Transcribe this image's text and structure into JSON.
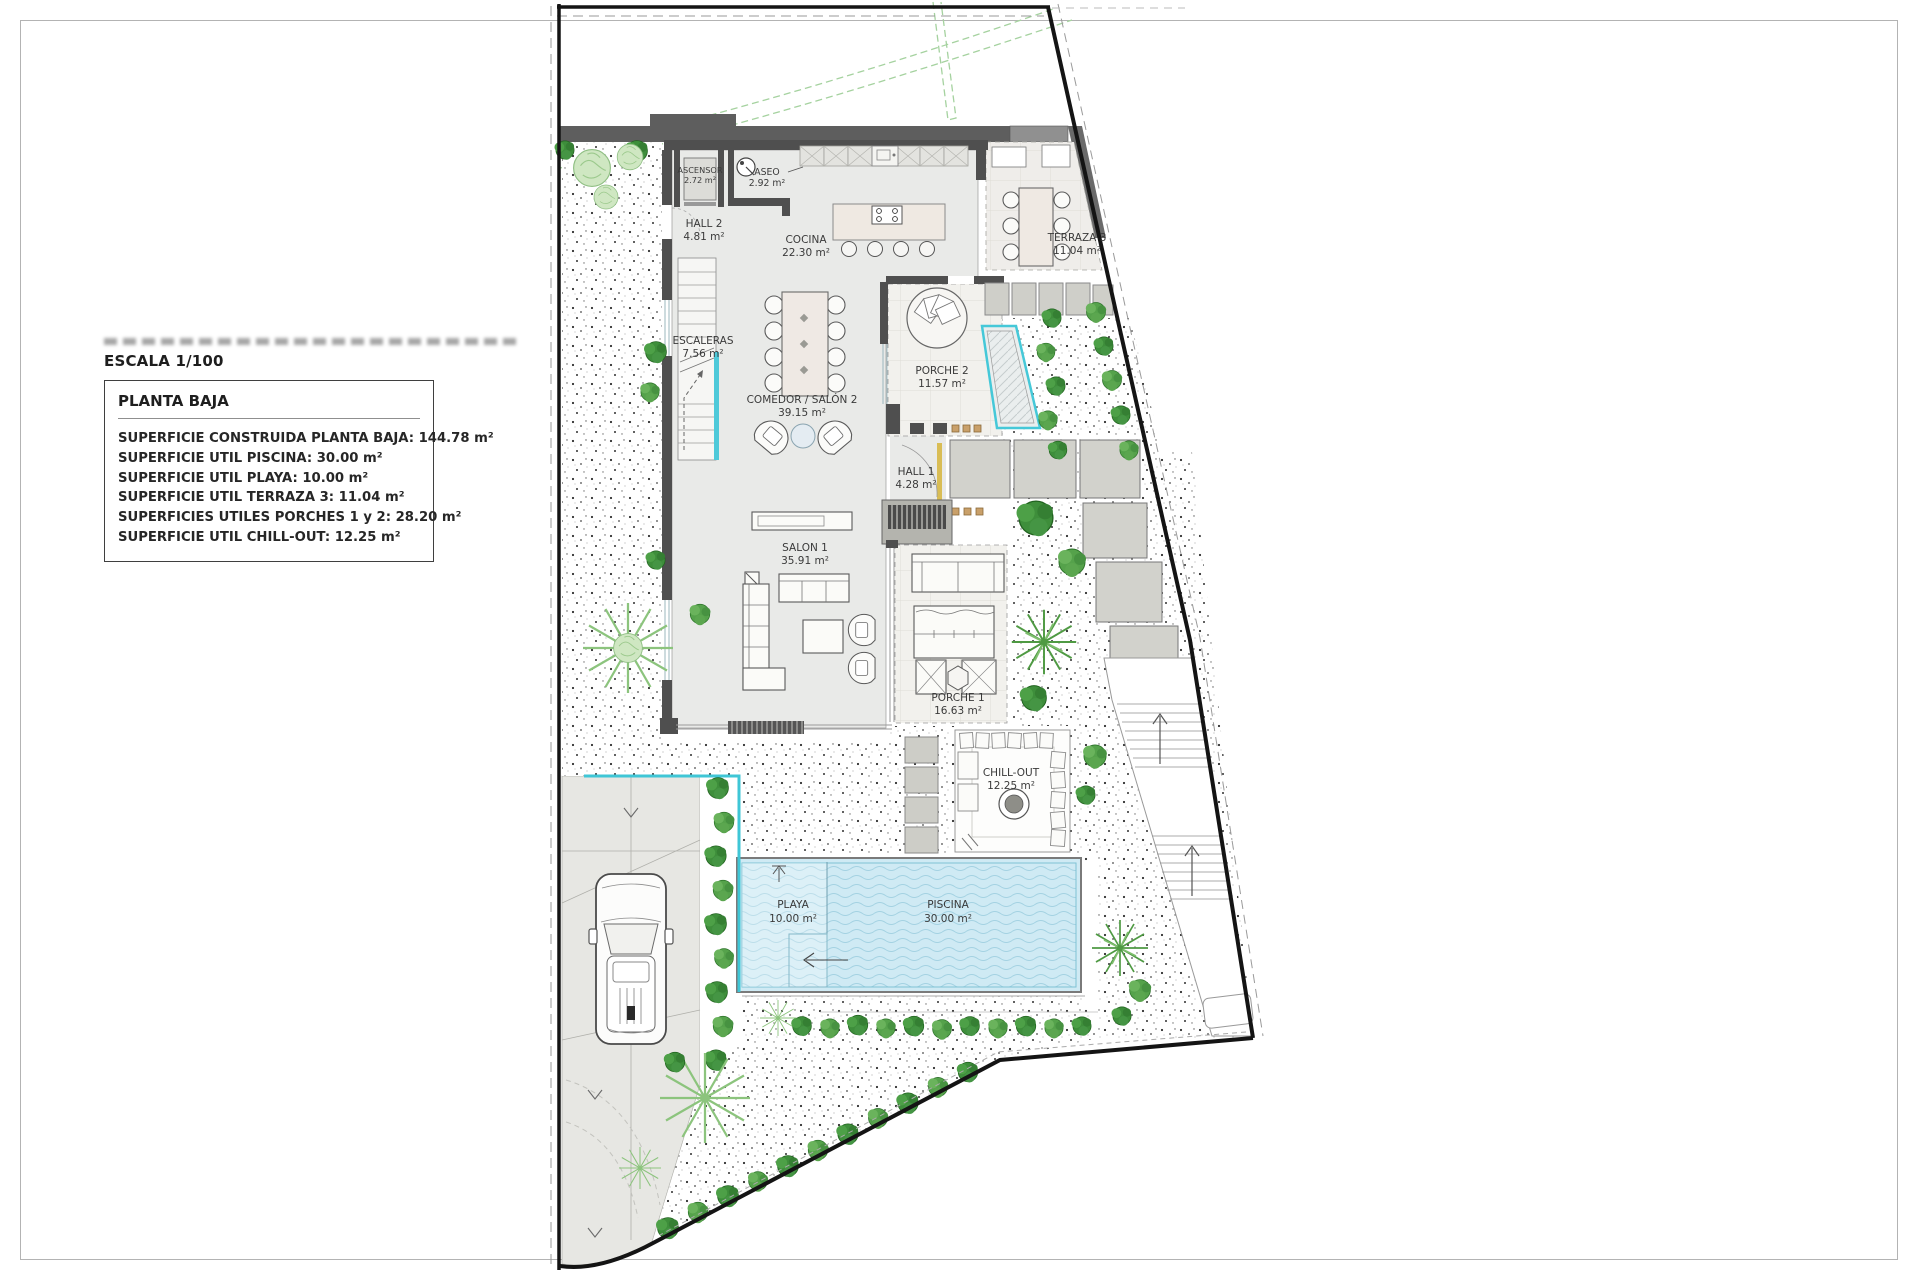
{
  "legend": {
    "scale_label": "ESCALA 1/100",
    "title": "PLANTA BAJA",
    "items": [
      "SUPERFICIE CONSTRUIDA PLANTA BAJA: 144.78 m²",
      "SUPERFICIE UTIL PISCINA: 30.00 m²",
      "SUPERFICIE UTIL PLAYA: 10.00 m²",
      "SUPERFICIE UTIL TERRAZA 3: 11.04 m²",
      "SUPERFICIES UTILES PORCHES 1 y 2: 28.20 m²",
      "SUPERFICIE UTIL CHILL-OUT: 12.25 m²"
    ]
  },
  "rooms": [
    {
      "name": "ASCENSOR",
      "area": "2.72 m²"
    },
    {
      "name": "ASEO",
      "area": "2.92 m²"
    },
    {
      "name": "HALL 2",
      "area": "4.81 m²"
    },
    {
      "name": "COCINA",
      "area": "22.30 m²"
    },
    {
      "name": "TERRAZA 3",
      "area": "11.04 m²"
    },
    {
      "name": "ESCALERAS",
      "area": "7.56 m²"
    },
    {
      "name": "COMEDOR / SALÓN 2",
      "area": "39.15 m²"
    },
    {
      "name": "PORCHE 2",
      "area": "11.57 m²"
    },
    {
      "name": "HALL 1",
      "area": "4.28 m²"
    },
    {
      "name": "SALON 1",
      "area": "35.91 m²"
    },
    {
      "name": "PORCHE 1",
      "area": "16.63 m²"
    },
    {
      "name": "CHILL-OUT",
      "area": "12.25 m²"
    },
    {
      "name": "PLAYA",
      "area": "10.00 m²"
    },
    {
      "name": "PISCINA",
      "area": "30.00 m²"
    }
  ],
  "colors": {
    "wall": "#4f4f4f",
    "interior_floor": "#e9eae8",
    "porch_floor": "#f2f1ed",
    "paver": "#d2d2cc",
    "pool_water": "#cfeaf4",
    "glass_accent": "#3fc6d6",
    "boundary": "#141414",
    "vegetation_dark": "#3e8e3b",
    "vegetation_light": "#cfe7c2",
    "door_accent": "#d9bd55"
  }
}
